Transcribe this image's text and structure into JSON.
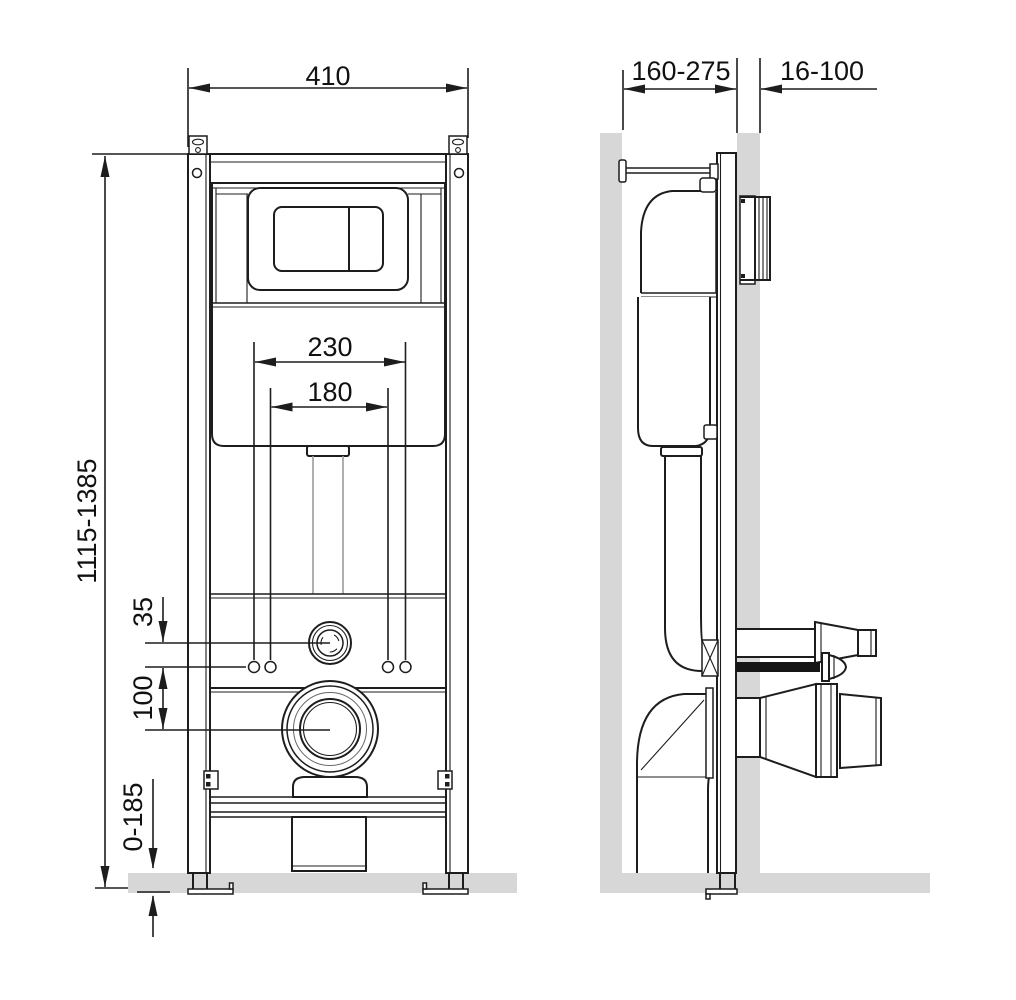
{
  "drawing": {
    "type": "wall-hung-wc-installation-frame",
    "views": {
      "front": "front-view",
      "side": "side-view"
    },
    "front_view": {
      "dim_frame_width": "410",
      "dim_frame_height": "1115-1385",
      "dim_fixing_outer": "230",
      "dim_fixing_inner": "180",
      "dim_inlet_offset": "35",
      "dim_outlet_offset": "100",
      "dim_foot_adjust": "0-185"
    },
    "side_view": {
      "dim_install_depth": "160-275",
      "dim_cladding_thickness": "16-100"
    },
    "colors": {
      "wall_fill": "#d7d7d7",
      "rod_fill": "#151515",
      "line": "#1d1d1d",
      "pipe_light": "#9b9b9b"
    }
  }
}
